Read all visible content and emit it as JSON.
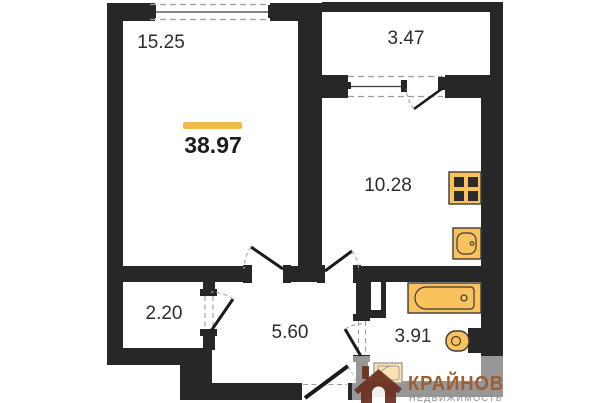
{
  "floor_plan": {
    "total_area": {
      "value": "38.97"
    },
    "rooms": [
      {
        "id": "living-room",
        "area": "15.25"
      },
      {
        "id": "balcony",
        "area": "3.47"
      },
      {
        "id": "kitchen",
        "area": "10.28"
      },
      {
        "id": "closet",
        "area": "2.20"
      },
      {
        "id": "hallway",
        "area": "5.60"
      },
      {
        "id": "bathroom",
        "area": "3.91"
      }
    ],
    "fixtures": [
      "stove-icon",
      "kitchen-sink-icon",
      "bathtub-icon",
      "toilet-icon",
      "bath-sink-icon"
    ],
    "colors": {
      "wall": "#272727",
      "accent": "#F2BA4E",
      "fixture_fill": "#F9C25C",
      "fixture_stroke": "#3b3b3b",
      "dash_gray": "#9c9c9c"
    }
  },
  "watermark": {
    "brand": "КРАЙНОВ",
    "subtitle": "НЕДВИЖИМОСТЬ",
    "brand_color": "#9c5f33",
    "subtitle_color": "#8e8e8e",
    "icon_color": "#6b2f1f"
  }
}
